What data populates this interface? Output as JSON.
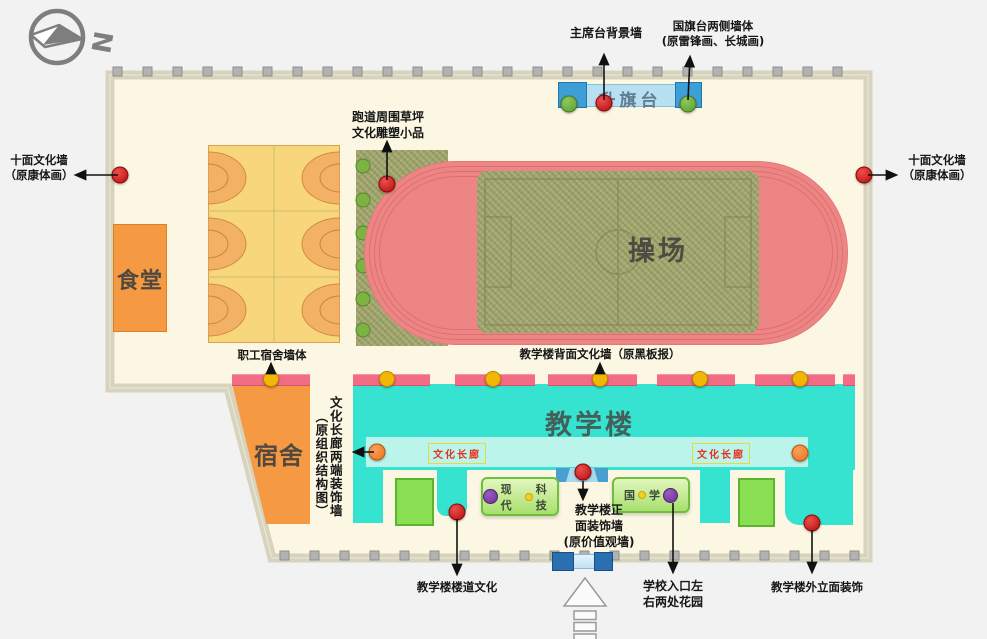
{
  "diagram": {
    "compass_letter": "N",
    "buildings": {
      "canteen": "食堂",
      "dormitory": "宿舍",
      "playground": "操场",
      "teaching_building": "教学楼",
      "flag_platform": "升旗台"
    },
    "signs": {
      "corridor_left": "文化长廊",
      "corridor_right": "文化长廊",
      "modern_tech_part1": "现代",
      "modern_tech_part2": "科技",
      "guoxue_part1": "国",
      "guoxue_part2": "学"
    },
    "callouts": {
      "stage_back_wall": {
        "line1": "主席台背景墙"
      },
      "flag_side_walls": {
        "line1": "国旗台两侧墙体",
        "line2": "(原雷锋画、长城画)"
      },
      "ten_walls_left": {
        "line1": "十面文化墙",
        "line2": "（原康体画）"
      },
      "ten_walls_right": {
        "line1": "十面文化墙",
        "line2": "（原康体画）"
      },
      "track_sculpture": {
        "line1": "跑道周围草坪",
        "line2": "文化雕塑小品"
      },
      "staff_dorm_wall": {
        "line1": "职工宿舍墙体"
      },
      "corridor_end_walls": {
        "line1": "文化长廊两端装饰墙",
        "line2": "（原组织结构图）"
      },
      "back_culture_wall": {
        "line1": "教学楼背面文化墙（原黑板报）"
      },
      "front_decor_wall": {
        "line1": "教学楼正",
        "line2": "面装饰墙",
        "line3": "(原价值观墙)"
      },
      "corridor_culture": {
        "line1": "教学楼楼道文化"
      },
      "entrance_gardens": {
        "line1": "学校入口左",
        "line2": "右两处花园"
      },
      "facade_decor": {
        "line1": "教学楼外立面装饰"
      }
    },
    "colors": {
      "campus_fill": "#fbf7e2",
      "wall": "#d7d3bd",
      "track_pink": "#ee8585",
      "grass_green": "#a3a771",
      "building_teal": "#35e3d0",
      "corridor_band": "#baf4ea",
      "building_orange": "#f59a43",
      "court_yellow": "#f8d77c",
      "court_orange": "#f2b164",
      "strip_pink": "#f26d84",
      "flag_light_blue": "#b7e0f2",
      "flag_dark_blue": "#3e9ed6",
      "marker_red": "#cc1414",
      "marker_green": "#6aae3c",
      "marker_yellow": "#f2b705",
      "marker_orange": "#ef8432",
      "marker_purple": "#7b3fa0"
    }
  }
}
